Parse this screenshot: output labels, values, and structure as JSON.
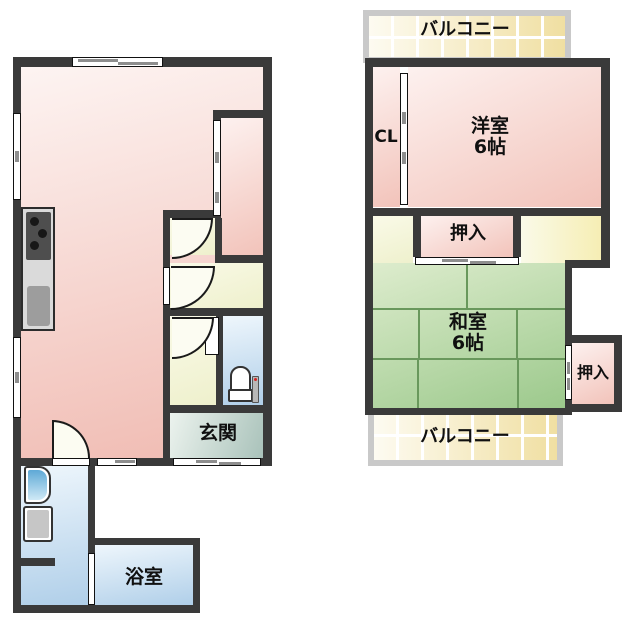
{
  "floor_plan": {
    "second_floor": {
      "balcony_top_label": "バルコニー",
      "closet_label": "CL",
      "western_room": {
        "name": "洋室",
        "size": "6帖"
      },
      "oshiire_top_label": "押入",
      "japanese_room": {
        "name": "和室",
        "size": "6帖"
      },
      "oshiire_side_label": "押入",
      "balcony_bottom_label": "バルコニー"
    },
    "first_floor": {
      "entrance_label": "玄関",
      "bathroom_label": "浴室"
    },
    "colors": {
      "wall": "#3a3a3a",
      "room_pink": "#f0bab1",
      "tatami_green": "#9cc98c",
      "tatami_line": "#69985c",
      "water_blue": "#b0cfe9",
      "corridor_cream": "#eef0cc",
      "balcony_yellow": "#f0dfa2",
      "balcony_frame": "#c9c9c9",
      "entrance_teal": "#a9c2ba"
    }
  }
}
